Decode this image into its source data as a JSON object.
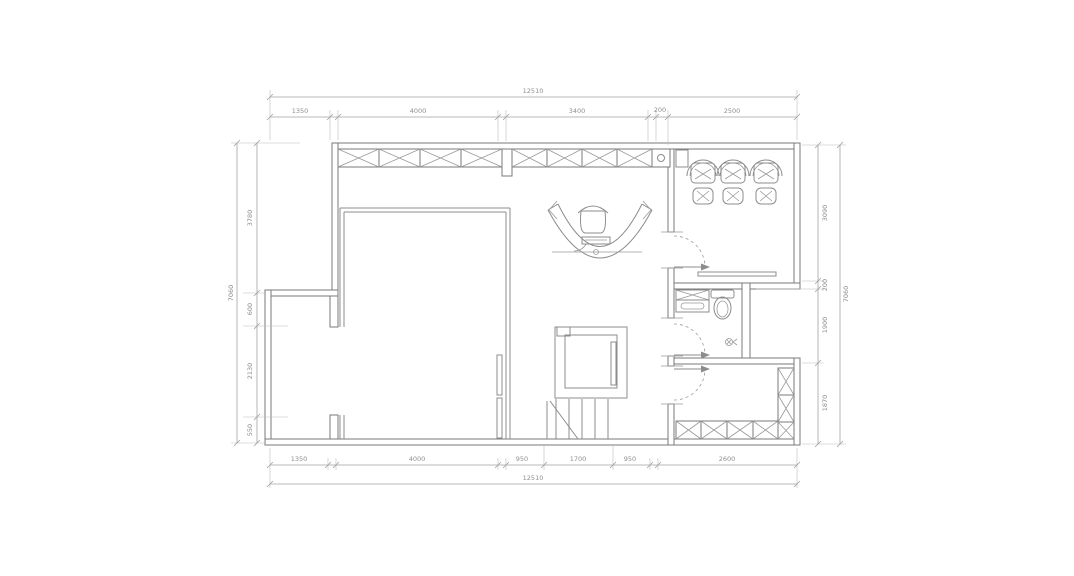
{
  "drawing": {
    "type": "architectural-floor-plan",
    "background": "#ffffff",
    "wall_color": "#7a7a7a",
    "line_color": "#8c8c8c",
    "dim_line_color": "#a2a2a2",
    "text_color": "#8e8e8e"
  },
  "dimensions": {
    "top": {
      "total": "12510",
      "segments": [
        "1350",
        "4000",
        "3400",
        "200",
        "2500"
      ]
    },
    "bottom": {
      "total": "12510",
      "segments": [
        "1350",
        "4000",
        "950",
        "1700",
        "950",
        "2600"
      ]
    },
    "left": {
      "total": "7060",
      "segments": [
        "3780",
        "600",
        "2130",
        "550"
      ]
    },
    "right": {
      "total": "7060",
      "segments": [
        "3090",
        "200",
        "1900",
        "1870"
      ]
    }
  },
  "fixtures": [
    "window-strip",
    "reception-desk",
    "office-chair",
    "keyboard",
    "elevator",
    "staircase",
    "armchair",
    "ottoman",
    "side-shelf",
    "toilet",
    "vanity-sink",
    "floor-drain",
    "wardrobe-cabinets",
    "sliding-door-panels",
    "swing-door",
    "wall-column"
  ]
}
